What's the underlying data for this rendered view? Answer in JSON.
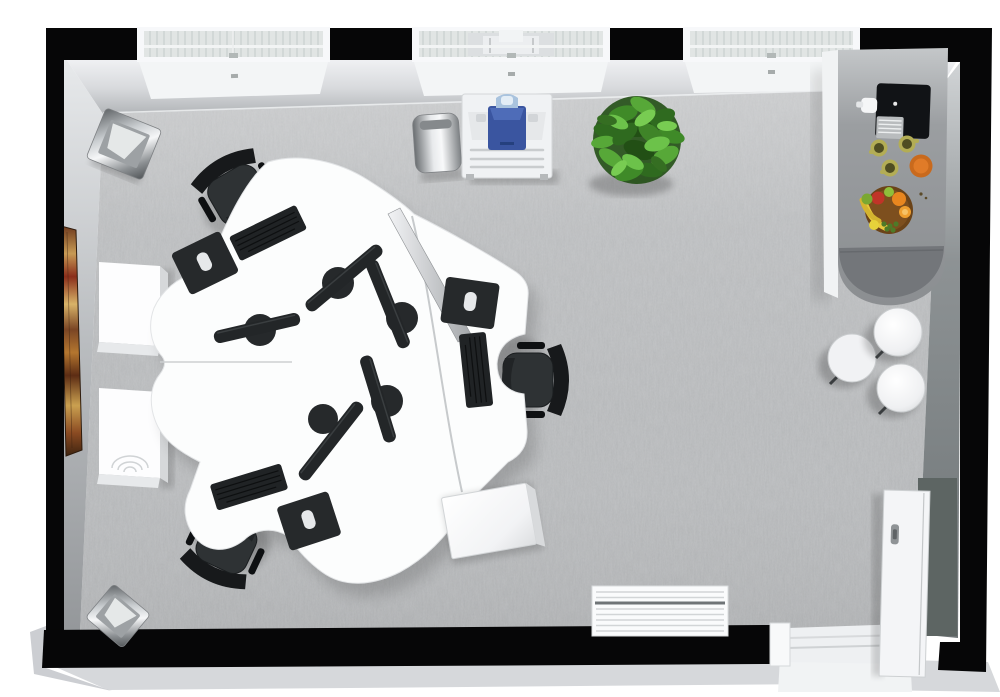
{
  "scene": {
    "kind": "3d-floor-plan-render",
    "view": "top-down-perspective",
    "room": "open-plan-office"
  },
  "palette": {
    "background": "#ffffff",
    "wall_black": "#060607",
    "wall_face_top": "#e9ebee",
    "wall_face_left": "#c9ccd0",
    "wall_face_right": "#74797c",
    "outer_band": "#d6d8db",
    "floor_carpet": "#b3b5b7",
    "desk_white": "#fcfdfd",
    "desk_seam": "#c7cacc",
    "divider_silver": "#c4c7ca",
    "chair_black": "#2e3234",
    "monitor_black": "#232628",
    "keyboard_black": "#202325",
    "mousepad_black": "#26292b",
    "mouse_white": "#e6e8ea",
    "counter_gray": "#8f9295",
    "counter_cap": "#73767a",
    "stool_white": "#f1f2f4",
    "plant_green": "#3f8428",
    "printer_body": "#f0f2f4",
    "printer_accent": "#3a55a0",
    "printer_handle": "#a9c3de",
    "bin_metal": "#c9cdd0",
    "cabinet_white": "#fdfdfe",
    "door_white": "#f4f5f7",
    "doorway_dark": "#5d6563",
    "radiator_white": "#fafbfc",
    "artwork_gold": "#c79a54",
    "artwork_red": "#8a2d1a",
    "mug_olive": "#b3ad55",
    "bowl_orange": "#c96a1d",
    "fruit_bowl_brown": "#6b4318",
    "banana_yellow": "#e8c83c",
    "orange_fruit": "#e8861f",
    "apple_red": "#c03428",
    "lime_green": "#8fbf3a",
    "coffee_machine_black": "#111316"
  },
  "inventory": {
    "windows": 3,
    "doors": 1,
    "desk_pods": 2,
    "desk_seats": 6,
    "office_chairs": 3,
    "monitors": 5,
    "keyboards": 3,
    "mouse_pads": 3,
    "side_cabinets": 2,
    "pedestal_cabinet": 1,
    "trash_bins": 3,
    "stools": 3,
    "plants": 1,
    "printer_stations": 1,
    "coffee_machines": 1,
    "mugs": 3,
    "bowls": 2,
    "radiators": 1,
    "wall_artworks": 1,
    "kitchen_counters": 1
  }
}
